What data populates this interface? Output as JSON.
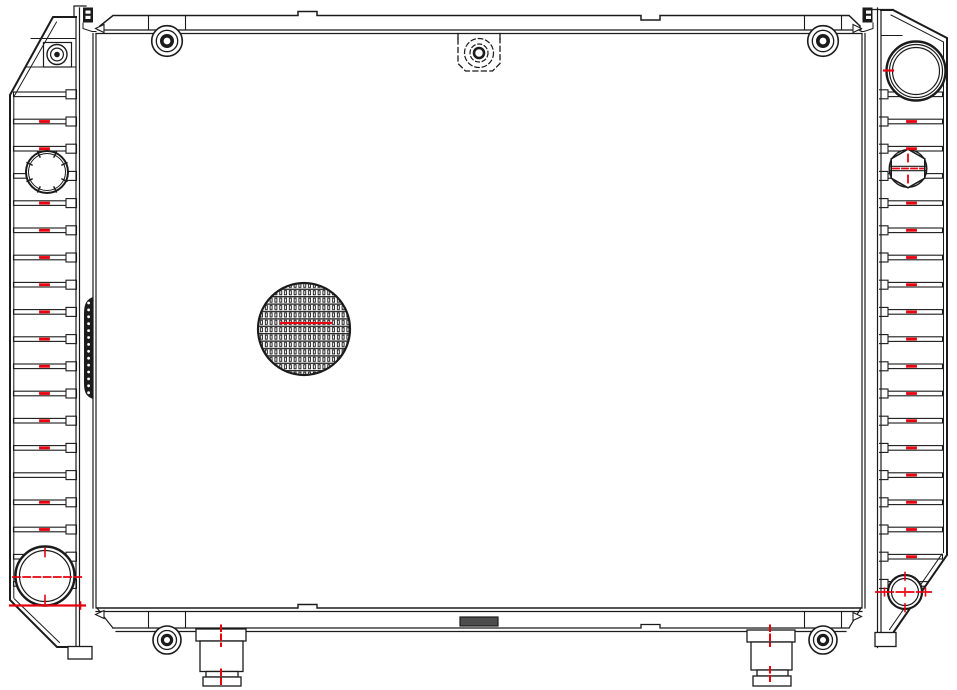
{
  "colors": {
    "line": "#1b1b1b",
    "accent": "#e8000f",
    "dark_fill": "#4d4d4d",
    "background": "#ffffff"
  },
  "drawing": {
    "description": "Automotive radiator - front elevation engineering line drawing",
    "parts": {
      "left_tank": "left side tank with cooling ribs",
      "right_tank": "right side tank with cooling ribs",
      "core": "radiator core",
      "top_rail": "top mounting rail",
      "bottom_rail": "bottom mounting rail",
      "filler_neck": "filler neck opening (top right)",
      "hex_plug": "hexagonal drain plug (right tank)",
      "cap_opening": "notched cap opening (left tank)",
      "hose_port_left": "lower hose port (left tank)",
      "hose_port_right": "lower hose port (right tank)",
      "mounting_brackets": "grommet mounting brackets (4)",
      "mounting_feet": "stepped mounting feet (2)",
      "fin_detail": "circular detail of core fin texture",
      "hidden_boss": "hidden mounting boss shown dashed (top center)",
      "seam_strip": "knurled side seam strip (left tank)"
    },
    "ribs": {
      "count": 19,
      "first_y": 92,
      "spacing": 27.2,
      "left": {
        "band_x": 13.5,
        "band_w": 54.5,
        "tab_x": 66,
        "target": "left-ribs"
      },
      "right": {
        "band_x": 885.5,
        "band_w": 57,
        "tab_x": 877.5,
        "target": "right-ribs"
      }
    },
    "red_rib_marks": {
      "left": {
        "x": 40.5,
        "len": 8,
        "rows": [
          1,
          2,
          4,
          5,
          6,
          7,
          8,
          9,
          10,
          11,
          12,
          13,
          15,
          16
        ],
        "target": "left-rib-marks"
      },
      "right": {
        "x": 907.5,
        "len": 8,
        "rows": [
          1,
          2,
          4,
          5,
          6,
          7,
          8,
          9,
          10,
          11,
          12,
          13,
          14,
          15,
          16,
          17
        ],
        "target": "right-rib-marks"
      }
    },
    "seam_dots": {
      "x": 88.6,
      "first_y": 303,
      "spacing": 6.9,
      "count": 14,
      "target": "seam-dots"
    }
  }
}
